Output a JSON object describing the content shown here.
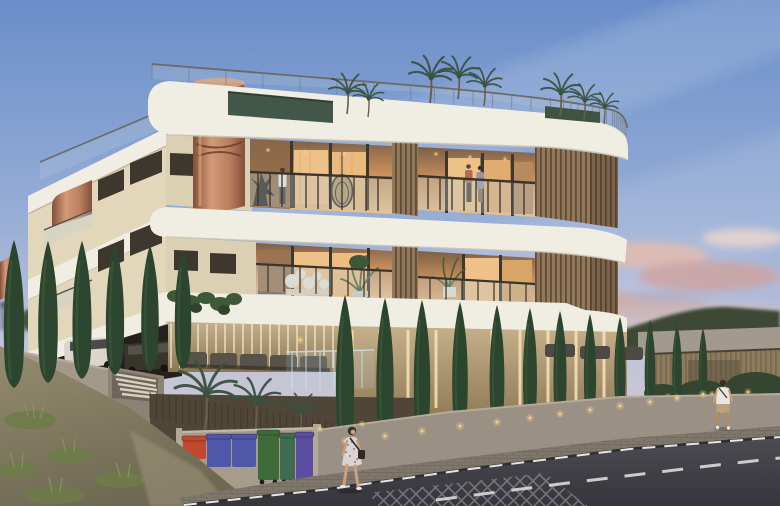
{
  "meta": {
    "title": "Dusk architectural rendering of a modern three-storey apartment building with rooftop palms, copper spiral stair, wood louvers, cypress-lined street, pedestrians and recycling bins",
    "scene_type": "architectural-render",
    "time_of_day": "dusk",
    "building": {
      "floors": 3,
      "features": [
        "rooftop glass railing with hedge and palm trees",
        "copper spiral staircase enclosure",
        "wood slat louver panels",
        "curved white balcony bands",
        "warm-lit interiors",
        "ground-floor parking with white van",
        "stone wall with vertical light strips"
      ]
    },
    "people": [
      {
        "id": "balcony-person",
        "desc": "person in white shirt on upper centre balcony"
      },
      {
        "id": "balcony-couple",
        "desc": "couple standing on upper right balcony"
      },
      {
        "id": "pedestrian-woman",
        "desc": "woman in floral dress walking on sidewalk with shoulder bag"
      },
      {
        "id": "pedestrian-man",
        "desc": "man in white t-shirt and beige shorts standing at street corner"
      }
    ]
  },
  "colors": {
    "sky-top": "#6a8ec9",
    "sky-mid": "#96add6",
    "sky-low": "#c0c3da",
    "sky-horizon": "#dbcbc9",
    "cloud-pink": "#e3bcae",
    "cloud-deep": "#cfa39d",
    "band-white": "#f0ede3",
    "band-shadow": "#cfc8b8",
    "facade-beige": "#dcd0b4",
    "west-face": "#e3d7bb",
    "slat-wood": "#93795a",
    "slat-dark": "#5e4c38",
    "copper": "#b97f5f",
    "copper-dark": "#84503a",
    "copper-light": "#d49a76",
    "glass-tint": "#b9cdd8",
    "frame-dark": "#3d372e",
    "interior-warm": "#eec189",
    "interior-amber": "#c98f5c",
    "interior-dim": "#7c5f47",
    "hedge": "#42564a",
    "palm": "#39523f",
    "cypress": "#2c452e",
    "cypress-light": "#41603a",
    "stone-warm": "#c6b08a",
    "strip-light": "#f6e4bb",
    "wall-gray": "#a3988a",
    "wall-gray-dark": "#7c746a",
    "garage-dark": "#24201a",
    "sofa": "#57524a",
    "grass": "#6e7c49",
    "hill": "#3e4936",
    "fence-wood": "#8b7a5d",
    "road": "#434249",
    "road-dark": "#36353b",
    "marking": "#d9d8d6",
    "sidewalk": "#7f776c",
    "bin-red": "#c1472f",
    "bin-blue": "#4f58a8",
    "bin-green": "#3e6a39",
    "bin-teal": "#3f6b52",
    "bin-purple": "#5b4da3",
    "skin": "#c9a17c",
    "glow": "#f6cf8d",
    "van-white": "#d9d6cd",
    "vehicle-dark": "#39352c"
  },
  "scene": {
    "cypress_left": [
      {
        "x": 14,
        "b": 388,
        "h": 148
      },
      {
        "x": 48,
        "b": 383,
        "h": 142
      },
      {
        "x": 82,
        "b": 379,
        "h": 138
      },
      {
        "x": 115,
        "b": 375,
        "h": 132
      },
      {
        "x": 150,
        "b": 372,
        "h": 127
      },
      {
        "x": 183,
        "b": 369,
        "h": 119
      }
    ],
    "cypress_front": [
      {
        "x": 345,
        "b": 447,
        "h": 152
      },
      {
        "x": 385,
        "b": 442,
        "h": 144
      },
      {
        "x": 422,
        "b": 437,
        "h": 137
      },
      {
        "x": 460,
        "b": 432,
        "h": 130
      },
      {
        "x": 497,
        "b": 428,
        "h": 123
      },
      {
        "x": 530,
        "b": 424,
        "h": 116
      },
      {
        "x": 560,
        "b": 420,
        "h": 109
      },
      {
        "x": 590,
        "b": 416,
        "h": 102
      },
      {
        "x": 620,
        "b": 412,
        "h": 95
      },
      {
        "x": 650,
        "b": 408,
        "h": 88
      },
      {
        "x": 677,
        "b": 404,
        "h": 80
      },
      {
        "x": 703,
        "b": 400,
        "h": 72
      }
    ],
    "roof_palms": [
      {
        "x": 347,
        "y": 114,
        "s": 0.9
      },
      {
        "x": 368,
        "y": 117,
        "s": 0.75
      },
      {
        "x": 430,
        "y": 103,
        "s": 1.05
      },
      {
        "x": 458,
        "y": 99,
        "s": 0.95
      },
      {
        "x": 484,
        "y": 106,
        "s": 0.85
      },
      {
        "x": 560,
        "y": 116,
        "s": 0.95
      },
      {
        "x": 584,
        "y": 120,
        "s": 0.8
      },
      {
        "x": 604,
        "y": 124,
        "s": 0.7
      }
    ],
    "garden_palms": [
      {
        "x": 205,
        "y": 430,
        "s": 1.5
      },
      {
        "x": 255,
        "y": 432,
        "s": 1.2
      },
      {
        "x": 300,
        "y": 434,
        "s": 0.9
      }
    ],
    "bins": [
      {
        "x": 183,
        "y": 440,
        "w": 23,
        "h": 19,
        "color": "bin-red"
      },
      {
        "x": 207,
        "y": 438,
        "w": 24,
        "h": 29,
        "color": "bin-blue"
      },
      {
        "x": 232,
        "y": 438,
        "w": 24,
        "h": 29,
        "color": "bin-blue"
      },
      {
        "x": 258,
        "y": 434,
        "w": 21,
        "h": 46,
        "color": "bin-green"
      },
      {
        "x": 280,
        "y": 437,
        "w": 15,
        "h": 43,
        "color": "bin-teal"
      },
      {
        "x": 296,
        "y": 436,
        "w": 17,
        "h": 45,
        "color": "bin-purple"
      }
    ],
    "light_strips": {
      "x0": 352,
      "dx": 28,
      "count": 10,
      "y0": 330,
      "y1": 408
    },
    "colonnade": {
      "x0": 171,
      "dx": 9,
      "count": 19,
      "y0": 324,
      "y1": 368
    },
    "bed_fence": {
      "x0": 150,
      "x1": 345,
      "dx": 6.5,
      "yTop0": 392,
      "yTop1": 424,
      "len": 26
    },
    "roof_rail": {
      "pts": [
        [
          152,
          64
        ],
        [
          420,
          86
        ],
        [
          560,
          98
        ],
        [
          612,
          110
        ],
        [
          626,
          122
        ]
      ],
      "count": 30,
      "drop": 15
    },
    "west_rail": {
      "pts": [
        [
          40,
          162
        ],
        [
          163,
          110
        ]
      ],
      "count": 10,
      "drop": 17
    }
  }
}
